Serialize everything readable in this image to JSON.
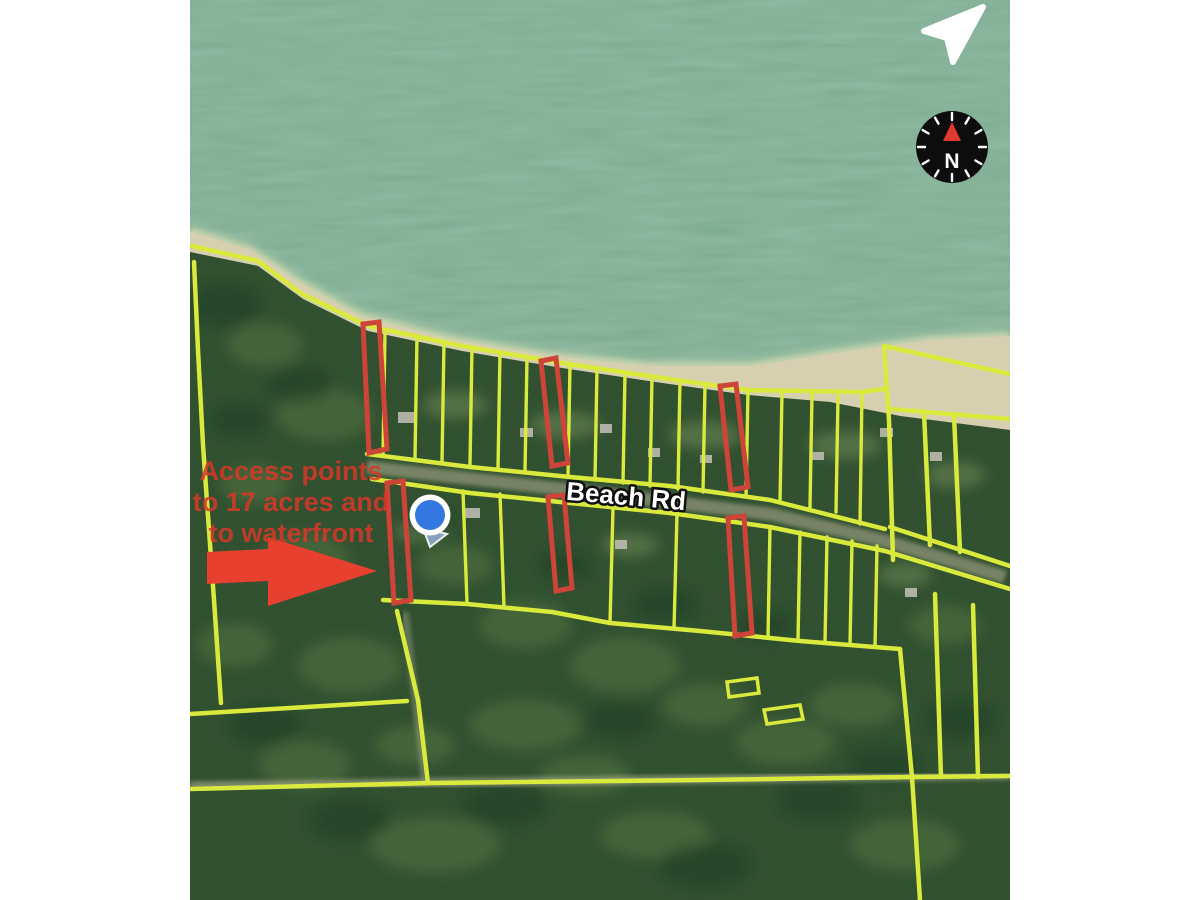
{
  "canvas": {
    "width": 1200,
    "height": 900,
    "margin_color": "#ffffff"
  },
  "map": {
    "road_label": "Beach Rd",
    "annotation": {
      "lines": [
        "Access points",
        "to 17 acres and",
        "to waterfront"
      ],
      "color": "#d93728"
    },
    "compass_label": "N",
    "icons": [
      "navigation-arrow-icon",
      "compass-icon",
      "location-dot"
    ],
    "colors": {
      "parcel_line": "#d9ea3d",
      "highlight": "#cf4439",
      "arrow": "#e8402f",
      "water": "#74a78a",
      "sand": "#d7d0b0",
      "forest": "#3a5f39",
      "location_dot": "#3577e0",
      "location_ring": "#ffffff",
      "compass_bg": "#0d0d0d",
      "compass_needle": "#e03a30"
    },
    "overlays": {
      "parcel_lines": [
        [
          [
            192,
            246
          ],
          [
            258,
            261
          ],
          [
            302,
            294
          ],
          [
            368,
            326
          ],
          [
            462,
            346
          ],
          [
            562,
            363
          ],
          [
            662,
            378
          ],
          [
            748,
            390
          ],
          [
            862,
            392
          ],
          [
            884,
            389
          ]
        ],
        [
          [
            884,
            346
          ],
          [
            1010,
            374
          ]
        ],
        [
          [
            884,
            346
          ],
          [
            889,
            420
          ],
          [
            893,
            560
          ]
        ],
        [
          [
            890,
            409
          ],
          [
            1010,
            419
          ]
        ],
        [
          [
            924,
            412
          ],
          [
            930,
            545
          ]
        ],
        [
          [
            954,
            415
          ],
          [
            960,
            552
          ]
        ],
        [
          [
            890,
            527
          ],
          [
            1010,
            566
          ]
        ],
        [
          [
            367,
            454
          ],
          [
            470,
            467
          ],
          [
            570,
            477
          ],
          [
            670,
            486
          ],
          [
            770,
            500
          ],
          [
            885,
            529
          ]
        ],
        [
          [
            372,
            479
          ],
          [
            470,
            493
          ],
          [
            570,
            503
          ],
          [
            670,
            513
          ],
          [
            770,
            527
          ],
          [
            885,
            551
          ],
          [
            1010,
            589
          ]
        ],
        [
          [
            383,
            600
          ],
          [
            467,
            604
          ],
          [
            552,
            612
          ],
          [
            610,
            623
          ],
          [
            700,
            631
          ],
          [
            800,
            641
          ],
          [
            900,
            649
          ]
        ],
        [
          [
            194,
            262
          ],
          [
            198,
            350
          ],
          [
            203,
            445
          ],
          [
            209,
            530
          ],
          [
            214,
            600
          ],
          [
            221,
            703
          ]
        ],
        [
          [
            190,
            714
          ],
          [
            407,
            701
          ]
        ],
        [
          [
            397,
            611
          ],
          [
            418,
            700
          ],
          [
            428,
            783
          ]
        ],
        [
          [
            190,
            789
          ],
          [
            430,
            783
          ],
          [
            700,
            780
          ],
          [
            912,
            777
          ],
          [
            1010,
            776
          ]
        ],
        [
          [
            912,
            777
          ],
          [
            920,
            900
          ]
        ],
        [
          [
            935,
            594
          ],
          [
            941,
            777
          ]
        ],
        [
          [
            973,
            605
          ],
          [
            978,
            777
          ]
        ],
        [
          [
            900,
            649
          ],
          [
            912,
            777
          ]
        ]
      ],
      "lot_dividers": [
        [
          385,
          331,
          383,
          456
        ],
        [
          417,
          336,
          415,
          459
        ],
        [
          444,
          341,
          442,
          462
        ],
        [
          472,
          347,
          470,
          465
        ],
        [
          500,
          352,
          498,
          469
        ],
        [
          527,
          357,
          525,
          472
        ],
        [
          570,
          364,
          568,
          477
        ],
        [
          597,
          368,
          595,
          480
        ],
        [
          625,
          372,
          623,
          483
        ],
        [
          652,
          376,
          650,
          486
        ],
        [
          680,
          380,
          678,
          489
        ],
        [
          705,
          384,
          703,
          492
        ],
        [
          748,
          390,
          746,
          497
        ],
        [
          782,
          392,
          780,
          502
        ],
        [
          812,
          394,
          810,
          507
        ],
        [
          838,
          396,
          836,
          512
        ],
        [
          862,
          392,
          860,
          524
        ],
        [
          463,
          491,
          467,
          603
        ],
        [
          500,
          494,
          504,
          607
        ],
        [
          613,
          508,
          610,
          623
        ],
        [
          677,
          514,
          674,
          629
        ],
        [
          770,
          527,
          768,
          638
        ],
        [
          800,
          532,
          798,
          641
        ],
        [
          827,
          537,
          825,
          643
        ],
        [
          852,
          541,
          850,
          645
        ],
        [
          877,
          546,
          875,
          647
        ]
      ],
      "highlight_lots": [
        [
          [
            363,
            324
          ],
          [
            379,
            322
          ],
          [
            387,
            449
          ],
          [
            369,
            453
          ]
        ],
        [
          [
            541,
            361
          ],
          [
            556,
            358
          ],
          [
            568,
            463
          ],
          [
            552,
            466
          ]
        ],
        [
          [
            720,
            386
          ],
          [
            736,
            384
          ],
          [
            748,
            487
          ],
          [
            731,
            490
          ]
        ],
        [
          [
            387,
            483
          ],
          [
            403,
            481
          ],
          [
            411,
            600
          ],
          [
            394,
            603
          ]
        ],
        [
          [
            548,
            497
          ],
          [
            564,
            495
          ],
          [
            572,
            588
          ],
          [
            556,
            591
          ]
        ],
        [
          [
            728,
            518
          ],
          [
            744,
            516
          ],
          [
            752,
            633
          ],
          [
            735,
            636
          ]
        ]
      ],
      "yellow_rects": [
        [
          [
            727,
            682
          ],
          [
            757,
            678
          ],
          [
            759,
            693
          ],
          [
            729,
            697
          ]
        ],
        [
          [
            764,
            710
          ],
          [
            800,
            705
          ],
          [
            803,
            719
          ],
          [
            767,
            724
          ]
        ]
      ],
      "arrow_polygon": [
        [
          207,
          552
        ],
        [
          268,
          549
        ],
        [
          268,
          537
        ],
        [
          377,
          571
        ],
        [
          268,
          606
        ],
        [
          268,
          581
        ],
        [
          207,
          584
        ]
      ],
      "location_dot": {
        "x": 430,
        "y": 515
      },
      "compass": {
        "x": 952,
        "y": 147,
        "r": 36
      }
    }
  }
}
